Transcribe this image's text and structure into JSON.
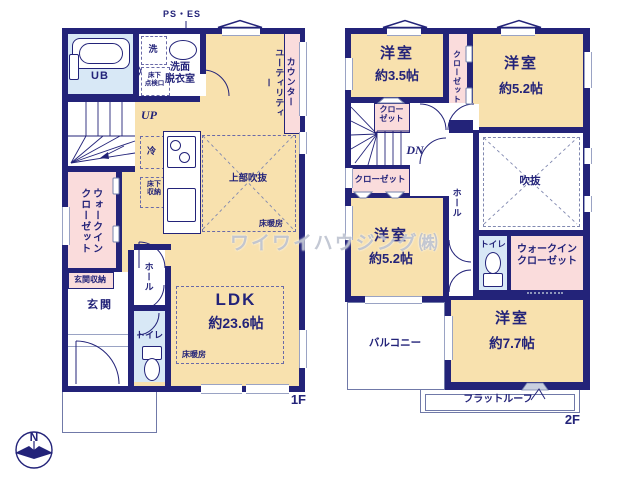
{
  "watermark": "ワイワイハウジング㈱",
  "compass": {
    "n": "N"
  },
  "colors": {
    "wall_navy": "#232379",
    "room_cream": "#f8e1ae",
    "closet_pink": "#fadcdc",
    "wet_area_blue": "#d8e8f6",
    "thin_outline": "#7079a8",
    "window_line": "#9aa3c4",
    "watermark_gray": "#c2c7d6"
  },
  "f1": {
    "floor": "1F",
    "ps_es": "PS・ES",
    "ub": "UB",
    "laundry": "洗",
    "hatch": "床下\n点検口",
    "washroom": "洗面\n脱衣室",
    "utility": "ユーティリティー",
    "counter": "カウンター",
    "up": "UP",
    "fridge": "冷",
    "floor_storage": "床下\n収納",
    "open_above": "上部吹抜",
    "heating_a": "床暖房",
    "heating_b": "床暖房",
    "wic": "ウォークイン\nクローゼット",
    "entry_storage": "玄関収納",
    "entry": "玄関",
    "hall": "ホール",
    "toilet": "トイレ",
    "ldk": "LDK",
    "ldk_size": "約23.6帖"
  },
  "f2": {
    "floor": "2F",
    "room35": "洋室",
    "room35_size": "約3.5帖",
    "room52a": "洋室",
    "room52a_size": "約5.2帖",
    "room52b": "洋室",
    "room52b_size": "約5.2帖",
    "room77": "洋室",
    "room77_size": "約7.7帖",
    "closet_strip": "クローゼット",
    "closet_a": "クロー\nゼット",
    "closet_b": "クローゼット",
    "wic": "ウォークイン\nクローゼット",
    "dn": "DN",
    "hall": "ホール",
    "void": "吹抜",
    "toilet": "トイレ",
    "balcony": "バルコニー",
    "flat_roof": "フラットルーフ"
  }
}
